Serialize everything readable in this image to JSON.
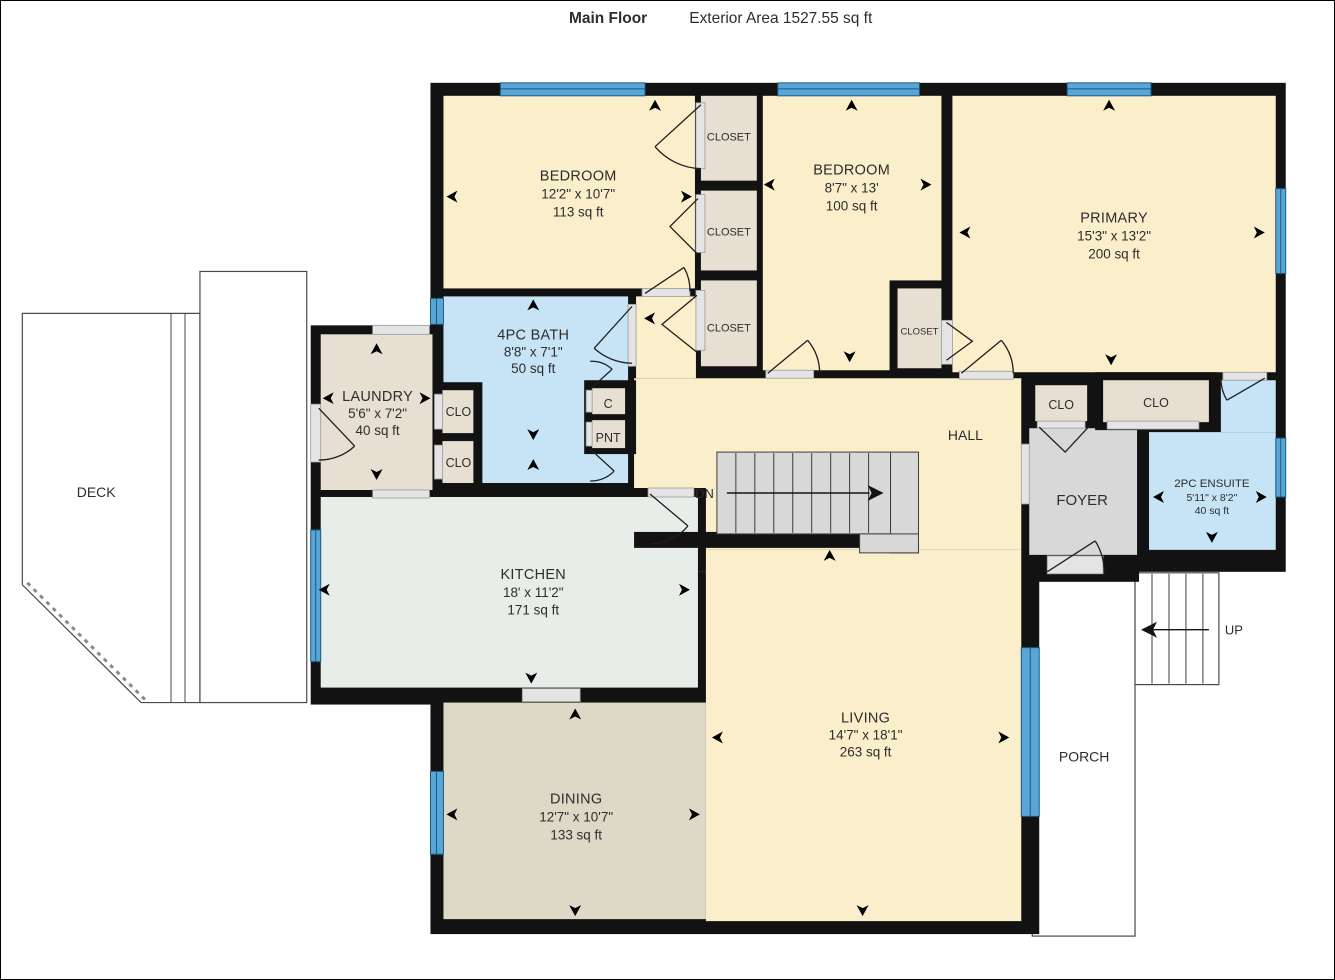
{
  "header": {
    "title": "Main Floor",
    "subtitle": "Exterior Area 1527.55 sq ft"
  },
  "rooms": {
    "bedroom1": {
      "name": "BEDROOM",
      "dims": "12'2\" x 10'7\"",
      "area": "113 sq ft"
    },
    "bedroom2": {
      "name": "BEDROOM",
      "dims": "8'7\" x 13'",
      "area": "100 sq ft"
    },
    "primary": {
      "name": "PRIMARY",
      "dims": "15'3\" x 13'2\"",
      "area": "200 sq ft"
    },
    "bath": {
      "name": "4PC BATH",
      "dims": "8'8\" x 7'1\"",
      "area": "50 sq ft"
    },
    "laundry": {
      "name": "LAUNDRY",
      "dims": "5'6\" x 7'2\"",
      "area": "40 sq ft"
    },
    "kitchen": {
      "name": "KITCHEN",
      "dims": "18' x 11'2\"",
      "area": "171 sq ft"
    },
    "dining": {
      "name": "DINING",
      "dims": "12'7\" x 10'7\"",
      "area": "133 sq ft"
    },
    "living": {
      "name": "LIVING",
      "dims": "14'7\" x 18'1\"",
      "area": "263 sq ft"
    },
    "ensuite": {
      "name": "2PC ENSUITE",
      "dims": "5'11\" x 8'2\"",
      "area": "40 sq ft"
    },
    "hall": {
      "name": "HALL"
    },
    "foyer": {
      "name": "FOYER"
    },
    "deck": {
      "name": "DECK"
    },
    "porch": {
      "name": "PORCH"
    }
  },
  "labels": {
    "closet": "CLOSET",
    "clo": "CLO",
    "cupboard": "C",
    "pantry": "PNT",
    "down": "DN",
    "up": "UP"
  },
  "colors": {
    "wall": "#121212",
    "window": "#58a6d8",
    "room_cream": "#fbeecb",
    "room_tan": "#e7dfd2",
    "room_dining": "#ded8c6",
    "room_blue": "#c6e4f6",
    "room_mint": "#e7eee9",
    "room_gray": "#d8d8d8"
  }
}
